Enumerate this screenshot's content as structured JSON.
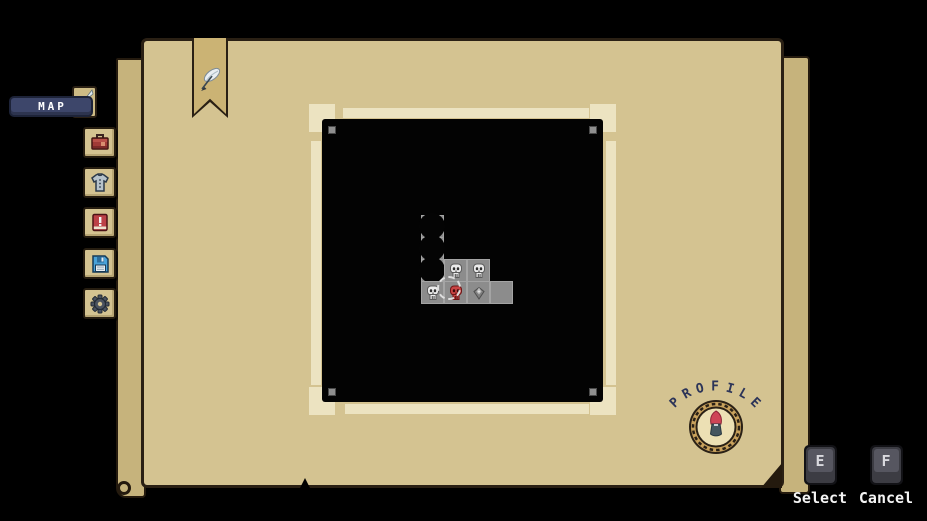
{
  "nav": {
    "map_tab_label": "MAP",
    "bookmark_icon": "quill-feather-icon",
    "mini_tab_icon": "flag-icon",
    "sidebar_items": [
      {
        "id": "inventory",
        "icon": "briefcase-icon"
      },
      {
        "id": "equipment",
        "icon": "shirt-icon"
      },
      {
        "id": "quests",
        "icon": "alert-book-icon"
      },
      {
        "id": "save",
        "icon": "floppy-disk-icon"
      },
      {
        "id": "settings",
        "icon": "gear-icon"
      }
    ]
  },
  "map": {
    "corner_pin_icon": "pin-square-icon",
    "grid": {
      "origin_x": 421,
      "origin_y": 215,
      "pitch_x": 23,
      "pitch_y": 22
    },
    "rooms": [
      {
        "col": 0,
        "row": 0,
        "type": "visited",
        "icon": null
      },
      {
        "col": 0,
        "row": 1,
        "type": "visited",
        "icon": null
      },
      {
        "col": 0,
        "row": 2,
        "type": "visited",
        "icon": null
      },
      {
        "col": 1,
        "row": 2,
        "type": "enemy",
        "icon": "skull-icon"
      },
      {
        "col": 2,
        "row": 2,
        "type": "enemy",
        "icon": "skull-icon"
      },
      {
        "col": 0,
        "row": 3,
        "type": "enemy",
        "icon": "skull-icon"
      },
      {
        "col": 1,
        "row": 3,
        "type": "current",
        "icon": "red-skull-icon"
      },
      {
        "col": 2,
        "row": 3,
        "type": "treasure",
        "icon": "diamond-icon"
      },
      {
        "col": 3,
        "row": 3,
        "type": "empty",
        "icon": null
      }
    ],
    "cursor": {
      "col": 1,
      "row": 3
    }
  },
  "profile": {
    "label": "PROFILE",
    "portrait_icon": "character-portrait-icon"
  },
  "controls": [
    {
      "key": "E",
      "action": "Select"
    },
    {
      "key": "F",
      "action": "Cancel"
    }
  ],
  "colors": {
    "background": "#000000",
    "panel_tan": "#d4c391",
    "panel_back_tan": "#c6b37c",
    "panel_border": "#2a2014",
    "frame_cream": "#ece3c1",
    "map_black": "#030303",
    "room_gray": "#8c8c8c",
    "tab_navy": "#3d466a",
    "profile_navy": "#2c3458",
    "skull_white": "#ebebeb",
    "skull_red": "#c84444",
    "key_gray": "#565660"
  }
}
